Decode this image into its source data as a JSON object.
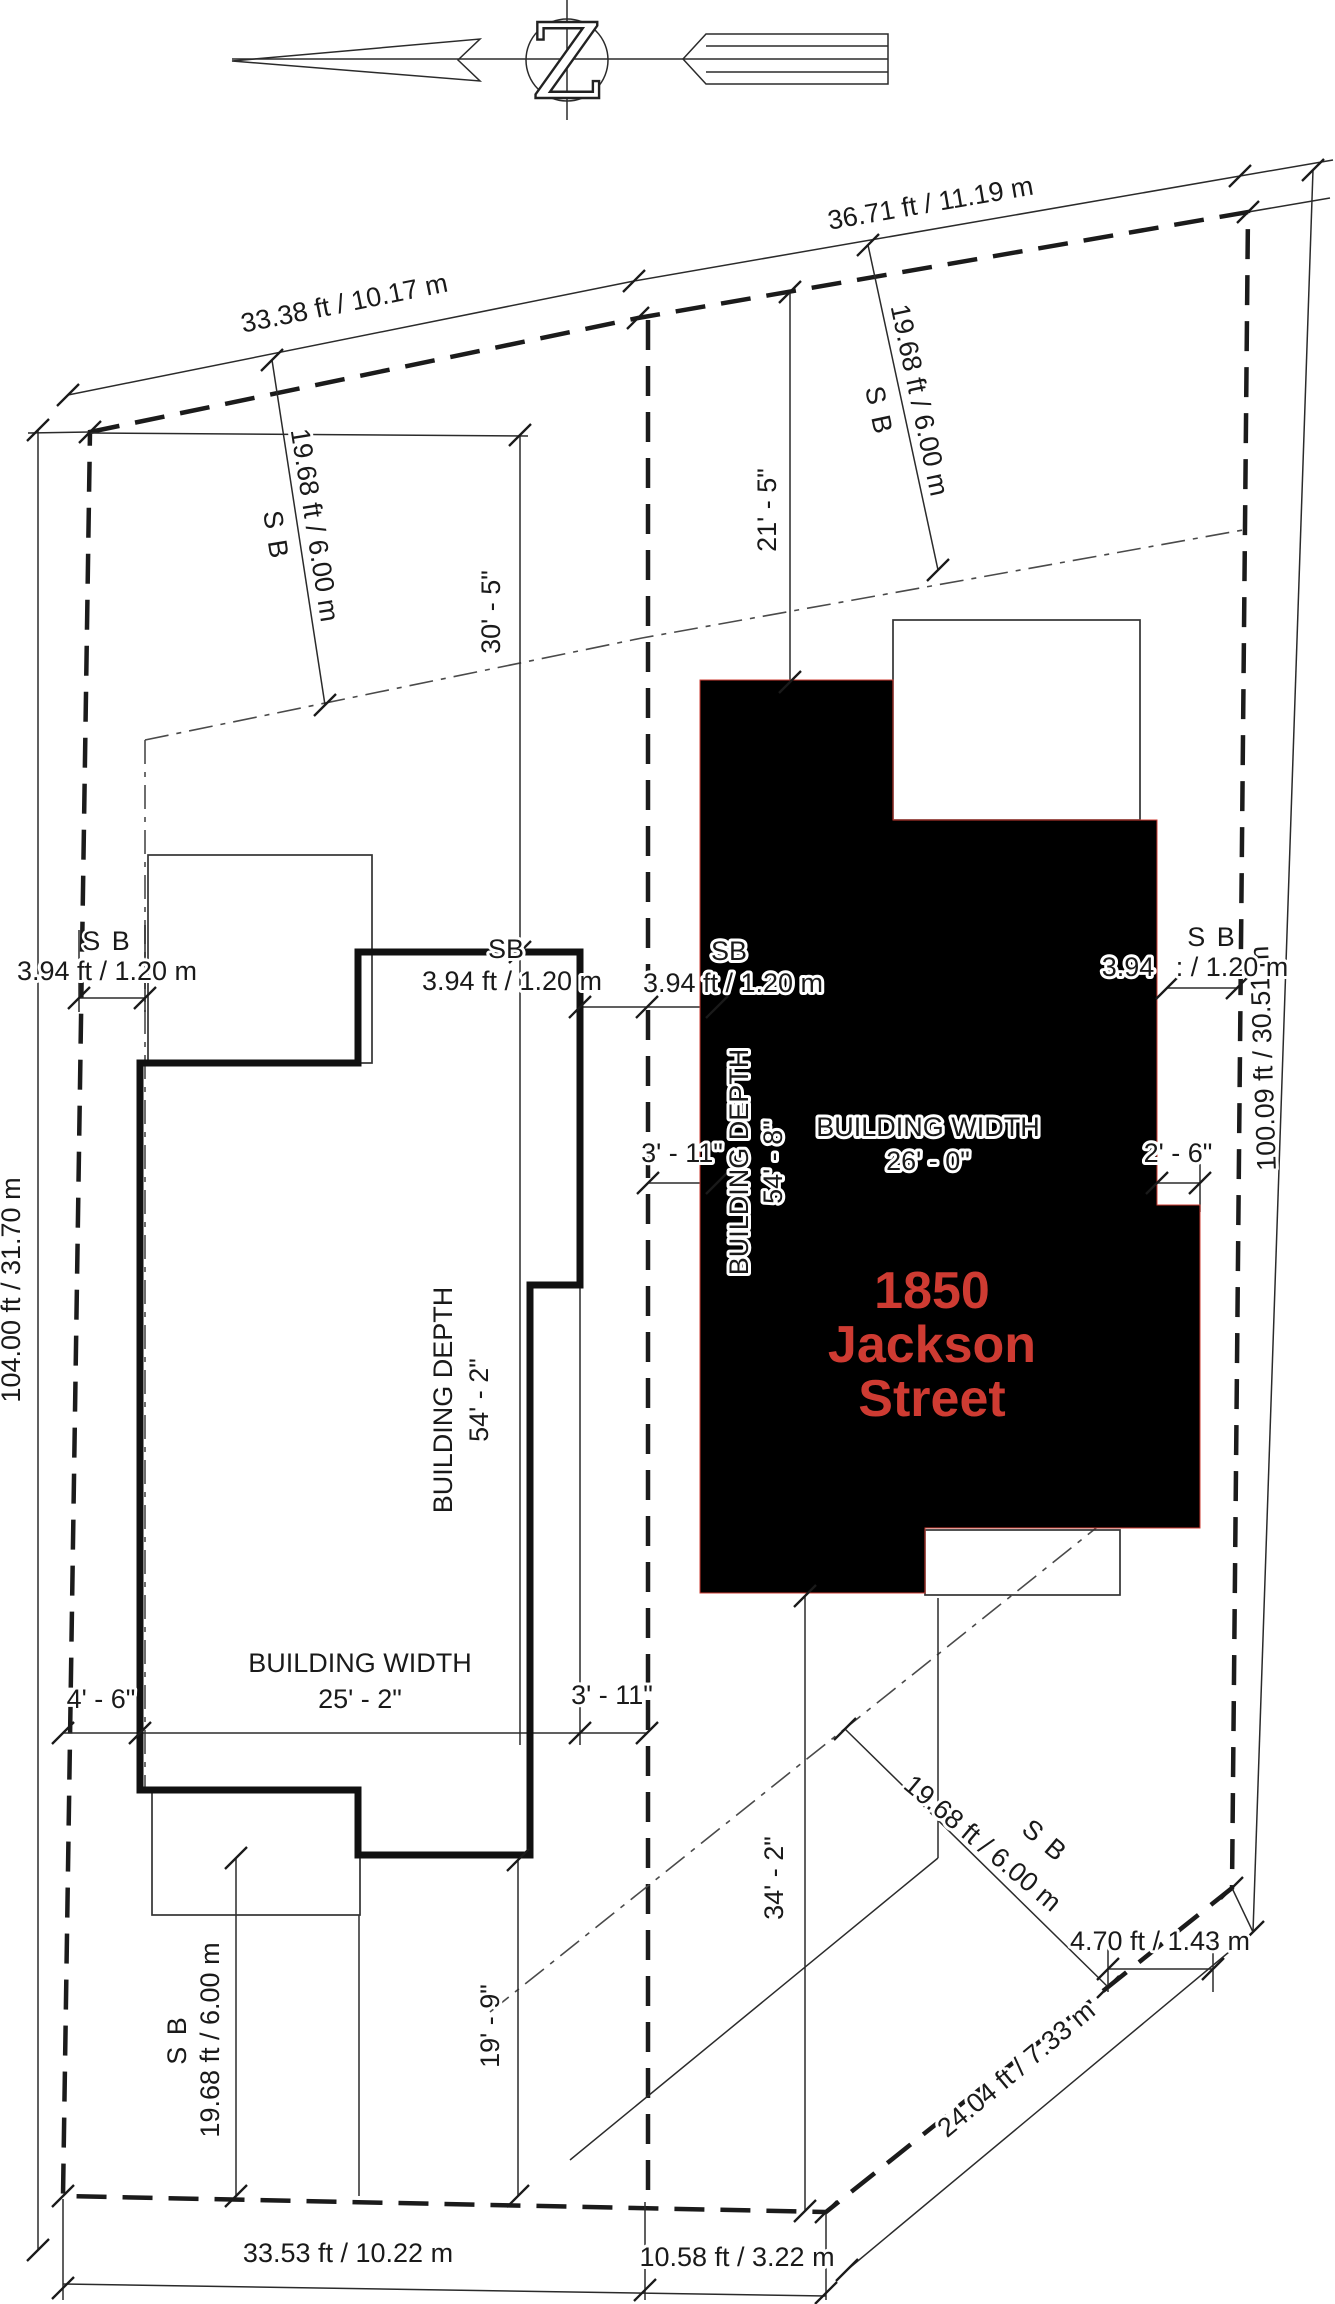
{
  "colors": {
    "red": "#ce3b32",
    "ink": "#1a1a1a"
  },
  "north": {
    "letter": "Z"
  },
  "address": {
    "line1": "1850",
    "line2": "Jackson",
    "line3": "Street"
  },
  "boundary_dims": {
    "top_left": "33.38 ft / 10.17 m",
    "top_right": "36.71 ft / 11.19 m",
    "right": "100.09 ft / 30.51 m",
    "left": "104.00 ft / 31.70 m",
    "bottom_left": "33.53 ft / 10.22 m",
    "bottom_mid": "10.58 ft / 3.22 m",
    "diag": "24.04 ft / 7.33 m",
    "corner": "4.70 ft / 1.43 m"
  },
  "setbacks": {
    "sb": "SB",
    "sb_spaced": "S B",
    "front_left": "19.68 ft / 6.00 m",
    "front_right": "19.68 ft / 6.00 m",
    "rear_left": "19.68 ft / 6.00 m",
    "diag": "19.68 ft / 6.00 m",
    "side_left": "3.94 ft / 1.20 m",
    "side_mid_left": "3.94 ft  / 1.20 m",
    "side_mid_right": "3.94 ft  / 1.20 m",
    "side_right_a": "3.94",
    "side_right_b": ": / 1.20 m"
  },
  "building_left": {
    "width_label": "BUILDING WIDTH",
    "width_value": "25' - 2\"",
    "depth_label": "BUILDING DEPTH",
    "depth_value": "54' - 2\"",
    "offset_left": "4' - 6\"",
    "offset_right": "3' - 11\"",
    "front_offset": "30' - 5\"",
    "rear_offset": "19' - 9\""
  },
  "building_right": {
    "width_label": "BUILDING WIDTH",
    "width_value": "26' - 0\"",
    "depth_label": "BUILDING DEPTH",
    "depth_value": "54' - 8\"",
    "offset_left": "3' - 11\"",
    "offset_right": "2' - 6\"",
    "front_offset": "21' - 5\"",
    "rear_offset": "34' - 2\""
  }
}
